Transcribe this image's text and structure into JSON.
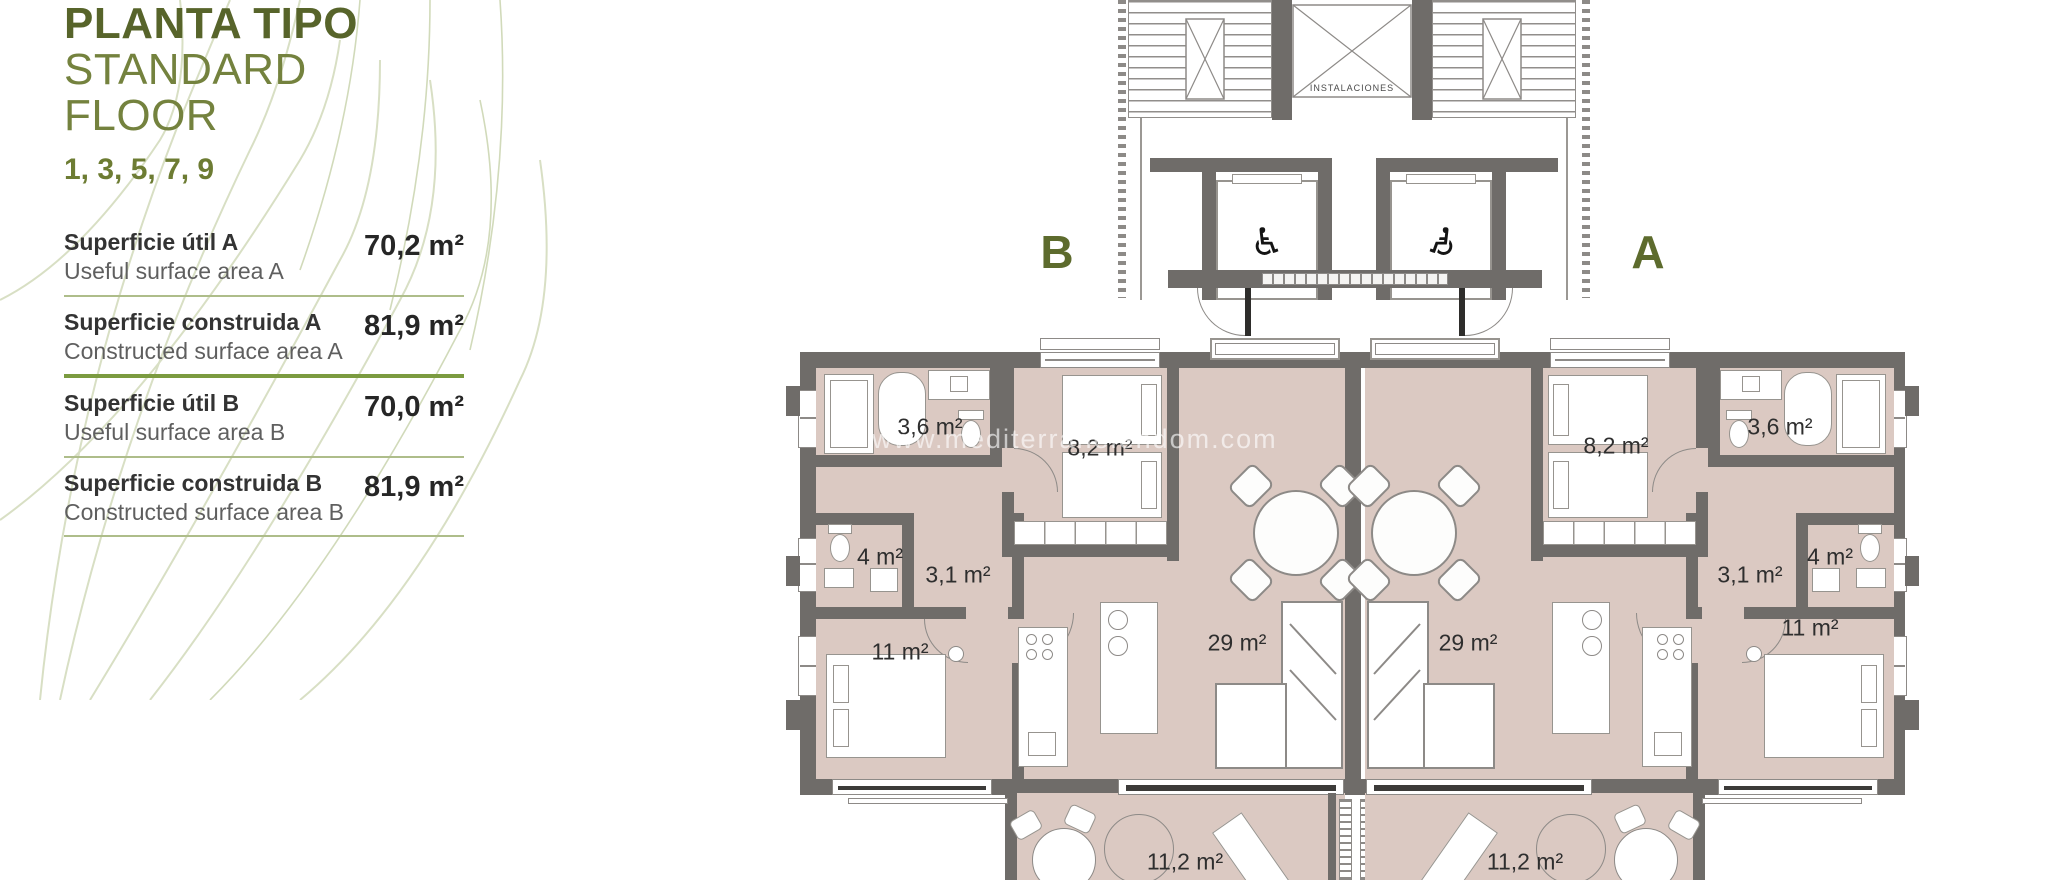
{
  "panel": {
    "title_es": "PLANTA TIPO",
    "title_en": "STANDARD FLOOR",
    "floors": "1, 3, 5, 7, 9",
    "rows": [
      {
        "label_es": "Superficie útil A",
        "label_en": "Useful surface area A",
        "value": "70,2 m²"
      },
      {
        "label_es": "Superficie construida A",
        "label_en": "Constructed surface area A",
        "value": "81,9 m²"
      },
      {
        "label_es": "Superficie útil B",
        "label_en": "Useful surface area B",
        "value": "70,0 m²"
      },
      {
        "label_es": "Superficie construida B",
        "label_en": "Constructed surface area B",
        "value": "81,9 m²"
      }
    ]
  },
  "plan": {
    "units": {
      "b": "B",
      "a": "A"
    },
    "core_label": "INSTALACIONES",
    "watermark": "www.mediterraneiendom.com",
    "rooms_b": {
      "bath_small": "3,6 m²",
      "bedroom_small": "8,2 m²",
      "bath": "4 m²",
      "hall": "3,1 m²",
      "bedroom": "11 m²",
      "living": "29 m²",
      "terrace": "11,2 m²"
    },
    "rooms_a": {
      "bath_small": "3,6 m²",
      "bedroom_small": "8,2 m²",
      "bath": "4 m²",
      "hall": "3,1 m²",
      "bedroom": "11 m²",
      "living": "29 m²",
      "terrace": "11,2 m²"
    }
  },
  "colors": {
    "accent_green": "#6d7c33",
    "divider_green": "#7b9b40",
    "wall_gray": "#6f6c69",
    "floor_beige": "#dbc9c2"
  }
}
